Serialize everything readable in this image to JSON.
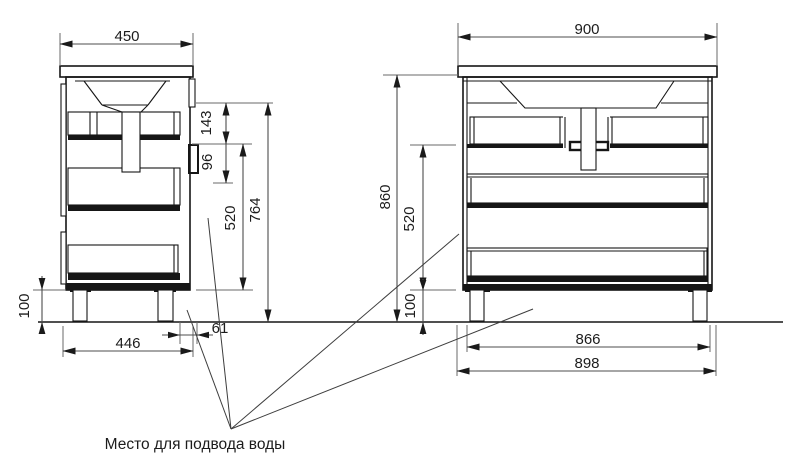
{
  "note": "Место для подвода воды",
  "left_view": {
    "top_width": "450",
    "upper_gap": "143",
    "supply_opening": "96",
    "drawer_section": "520",
    "body_height": "764",
    "leg_height": "100",
    "base_width": "446",
    "rear_offset": "61"
  },
  "right_view": {
    "top_width": "900",
    "overall_height": "860",
    "drawer_section": "520",
    "leg_height": "100",
    "leg_span": "866",
    "base_width": "898"
  }
}
